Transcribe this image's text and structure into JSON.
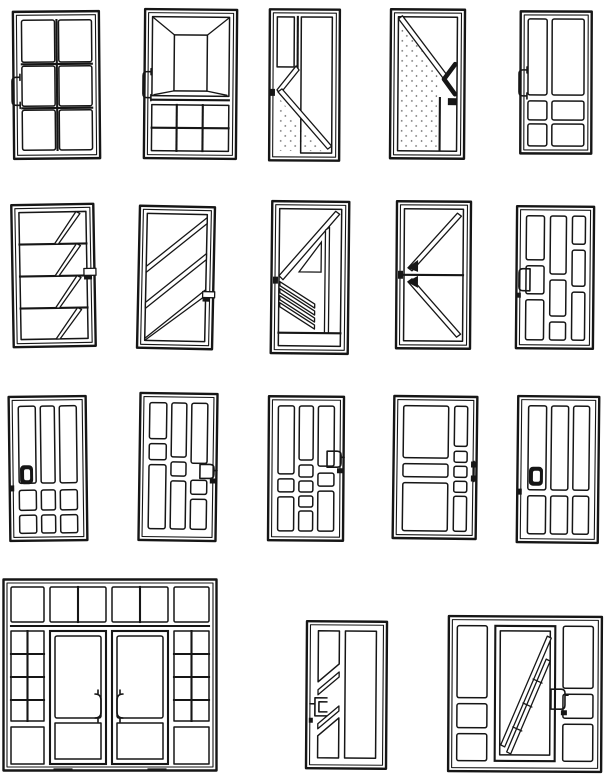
{
  "page": {
    "kind": "scanned-catalog-of-door-design-line-drawings",
    "background": "#ffffff",
    "ink": "#161616",
    "rows": 4,
    "total_designs": 18
  },
  "designs": [
    {
      "id": "design-01",
      "name": "six-pane-grid-door",
      "row": 1,
      "handle_side": "left"
    },
    {
      "id": "design-02",
      "name": "perspective-panel-top-grid-bottom-door",
      "row": 1,
      "handle_side": "left"
    },
    {
      "id": "design-03",
      "name": "chevron-left-long-diagonal-door",
      "row": 1,
      "handle_side": "left",
      "glazing": "stippled-lower-left"
    },
    {
      "id": "design-04",
      "name": "diagonal-with-right-arrow-door",
      "row": 1,
      "handle_side": "right",
      "glazing": "stippled-left-panel"
    },
    {
      "id": "design-05",
      "name": "two-vertical-over-four-pane-door",
      "row": 1,
      "handle_side": "left"
    },
    {
      "id": "design-06",
      "name": "four-band-cascade-diagonal-door",
      "row": 2,
      "handle_side": "right"
    },
    {
      "id": "design-07",
      "name": "triple-diagonal-stripe-door",
      "row": 2,
      "handle_side": "right"
    },
    {
      "id": "design-08",
      "name": "triangle-and-louver-fan-door",
      "row": 2,
      "handle_side": "left"
    },
    {
      "id": "design-09",
      "name": "sideways-v-split-door",
      "row": 2,
      "handle_side": "left"
    },
    {
      "id": "design-10",
      "name": "staggered-brick-pane-door",
      "row": 2,
      "handle_side": "left"
    },
    {
      "id": "design-11",
      "name": "three-panel-stippled-center-door",
      "row": 3,
      "handle_side": "left"
    },
    {
      "id": "design-12",
      "name": "staggered-three-column-door",
      "row": 3,
      "handle_side": "right"
    },
    {
      "id": "design-13",
      "name": "three-column-stacked-square-door",
      "row": 3,
      "handle_side": "right"
    },
    {
      "id": "design-14",
      "name": "wide-panel-with-side-column-door",
      "row": 3,
      "handle_side": "right"
    },
    {
      "id": "design-15",
      "name": "three-over-three-panel-door",
      "row": 3,
      "handle_side": "left"
    },
    {
      "id": "design-16",
      "name": "storefront-double-door-with-sidelights-and-transom",
      "row": 4,
      "handle_side": "center-pair",
      "glazing": "stippled-kick-panels"
    },
    {
      "id": "design-17",
      "name": "hatched-panel-door-with-diagonal-side-strip",
      "row": 4,
      "handle_side": "left",
      "glazing": "diagonal-hatch-right-panel"
    },
    {
      "id": "design-18",
      "name": "diagonal-ladder-door-with-sidelights",
      "row": 4,
      "handle_side": "right"
    }
  ]
}
